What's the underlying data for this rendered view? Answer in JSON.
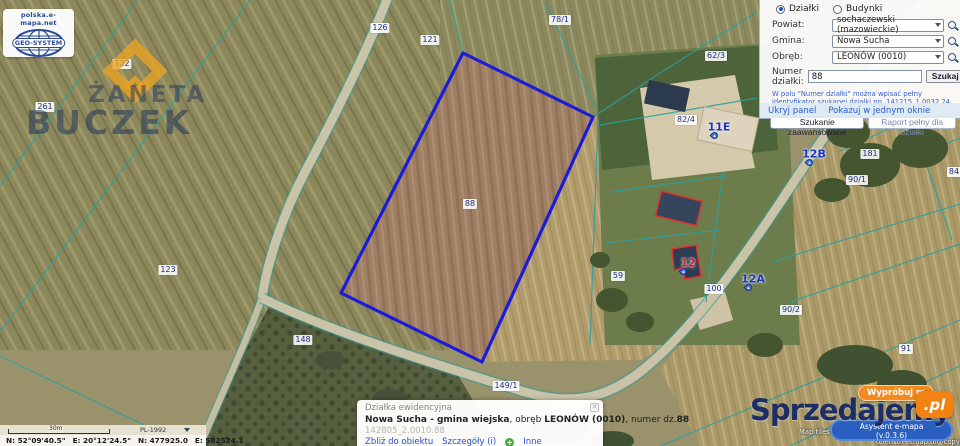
{
  "logo": {
    "site": "polska.e-mapa.net",
    "company": "GEO-SYSTEM"
  },
  "watermark": {
    "line1": "ŻANETA",
    "line2": "BUCZEK"
  },
  "search_panel": {
    "radio_parcels": "Działki",
    "radio_buildings": "Budynki",
    "fields": [
      {
        "label": "Powiat:",
        "value": "sochaczewski (mazowieckie)"
      },
      {
        "label": "Gmina:",
        "value": "Nowa Sucha"
      },
      {
        "label": "Obręb:",
        "value": "LEONÓW (0010)"
      }
    ],
    "parcel_field": {
      "label": "Numer działki:",
      "value": "88"
    },
    "search_button": "Szukaj",
    "hint": "W polu \"Numer działki\" można wpisać pełny identyfikator szukanej działki np. 141215_1.0032.24 zamiast wyboru powiatu, gminy, obrębu.",
    "advanced_button": "Szukanie zaawansowane",
    "report_button": "Raport pełny dla działki",
    "hide_panel_link": "Ukryj panel",
    "single_window_link": "Pokazuj w jednym oknie"
  },
  "map": {
    "selected_parcel_color": "#1c1cd8",
    "boundary_color": "#2d9f9f",
    "parcel_labels": [
      {
        "text": "122",
        "x": 122,
        "y": 64
      },
      {
        "text": "126",
        "x": 380,
        "y": 28
      },
      {
        "text": "121",
        "x": 430,
        "y": 40
      },
      {
        "text": "78/1",
        "x": 560,
        "y": 20
      },
      {
        "text": "261",
        "x": 45,
        "y": 107
      },
      {
        "text": "62/3",
        "x": 716,
        "y": 56
      },
      {
        "text": "82/4",
        "x": 686,
        "y": 120
      },
      {
        "text": "181",
        "x": 870,
        "y": 154
      },
      {
        "text": "84",
        "x": 954,
        "y": 172
      },
      {
        "text": "90/1",
        "x": 857,
        "y": 180
      },
      {
        "text": "88",
        "x": 470,
        "y": 204
      },
      {
        "text": "123",
        "x": 168,
        "y": 270
      },
      {
        "text": "59",
        "x": 618,
        "y": 276
      },
      {
        "text": "100",
        "x": 714,
        "y": 289
      },
      {
        "text": "90/2",
        "x": 791,
        "y": 310
      },
      {
        "text": "148",
        "x": 303,
        "y": 340
      },
      {
        "text": "91",
        "x": 906,
        "y": 349
      },
      {
        "text": "149/1",
        "x": 506,
        "y": 386
      },
      {
        "text": "95",
        "x": 893,
        "y": 394
      }
    ],
    "address_markers": [
      {
        "text": "11E",
        "x": 719,
        "y": 127,
        "color": "#1a35cc"
      },
      {
        "text": "12B",
        "x": 814,
        "y": 154,
        "color": "#1a35cc"
      },
      {
        "text": "12A",
        "x": 753,
        "y": 279,
        "color": "#1a35cc"
      },
      {
        "text": "12",
        "x": 688,
        "y": 263,
        "color": "#d42020"
      }
    ]
  },
  "scale_bar": {
    "distance": "30m",
    "crs": "PL-1992"
  },
  "coordinates": {
    "n_dms": "N: 52°09'40.5\"",
    "e_dms": "E: 20°12'24.5\"",
    "n_pl": "N: 477925.0",
    "e_pl": "E: 582524.1"
  },
  "info_panel": {
    "title": "Działka ewidencyjna",
    "name_bold": "Nowa Sucha - gmina wiejska",
    "sep1": ", obręb ",
    "obreb_bold": "LEONÓW (0010)",
    "sep2": ", numer dz.",
    "number_bold": "88",
    "parcel_id": "142805_2.0010.88",
    "link_zoom": "Zbliż do obiektu",
    "link_details": "Szczegóły (i)",
    "link_other": "Inne"
  },
  "promo": {
    "brand": "Sprzedajemy",
    "brand_tld": ".pl",
    "try_button": "Wypróbuj m",
    "assistant_name": "Asystent e-mapa",
    "assistant_version": "(v.0.3.6)",
    "attribution_left": "Map tiles",
    "attribution_right": "openstreetmap.org/copyright"
  }
}
